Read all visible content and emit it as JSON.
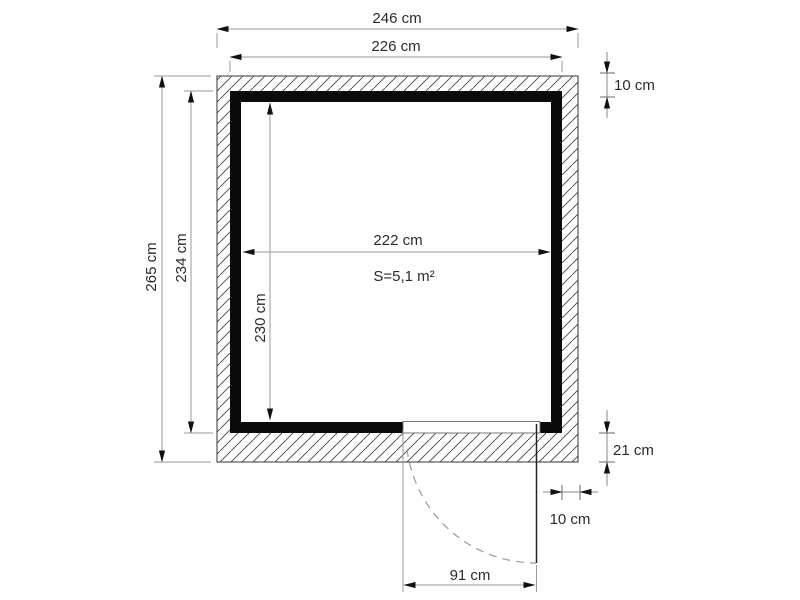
{
  "diagram": {
    "type": "floor-plan",
    "area_label": "S=5,1 m²",
    "unit_note": "cm",
    "dims": {
      "overall_width": "246 cm",
      "wall_outer_width": "226 cm",
      "overall_depth": "265 cm",
      "wall_outer_depth": "234 cm",
      "interior_width": "222 cm",
      "interior_depth": "230 cm",
      "wall_thickness_top": "10 cm",
      "base_band_depth": "21 cm",
      "door_side_offset": "10 cm",
      "door_width": "91 cm"
    }
  }
}
